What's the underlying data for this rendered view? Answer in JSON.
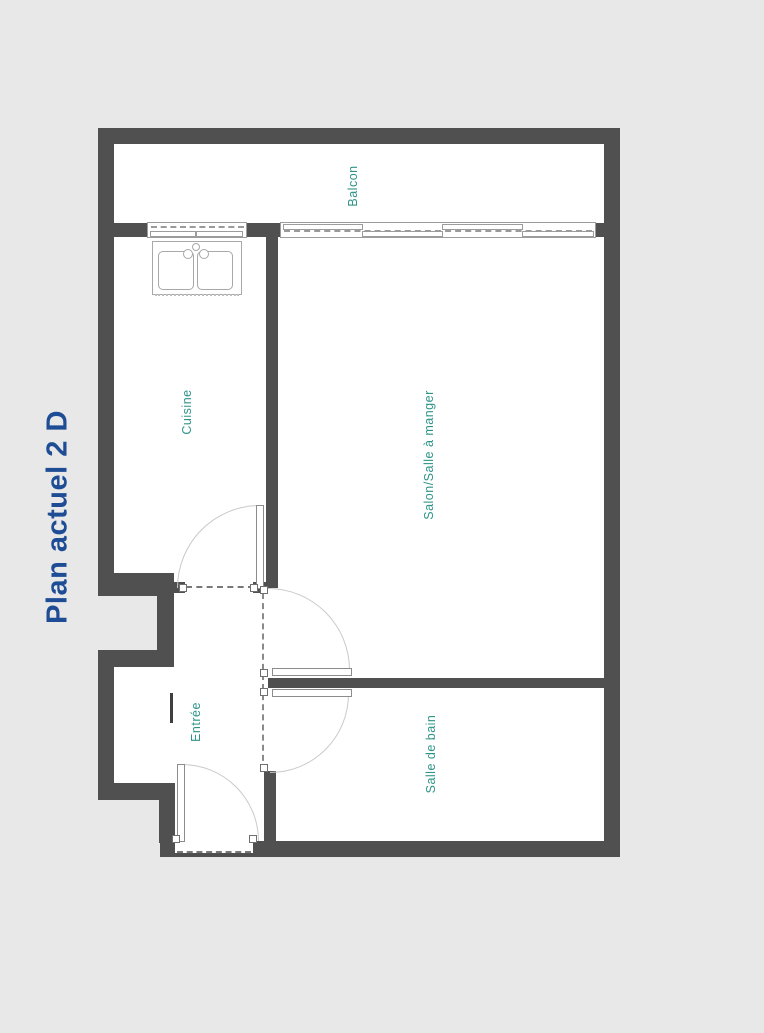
{
  "title": "Plan actuel 2 D",
  "rooms": {
    "balcon": "Balcon",
    "cuisine": "Cuisine",
    "salon": "Salon/Salle à manger",
    "entree": "Entrée",
    "salle_de_bain": "Salle de bain"
  },
  "colors": {
    "background": "#e8e8e8",
    "interior": "#ffffff",
    "wall": "#505050",
    "room_label": "#2e9488",
    "title": "#1e4d95",
    "fixture_line": "#a8a8a8"
  }
}
